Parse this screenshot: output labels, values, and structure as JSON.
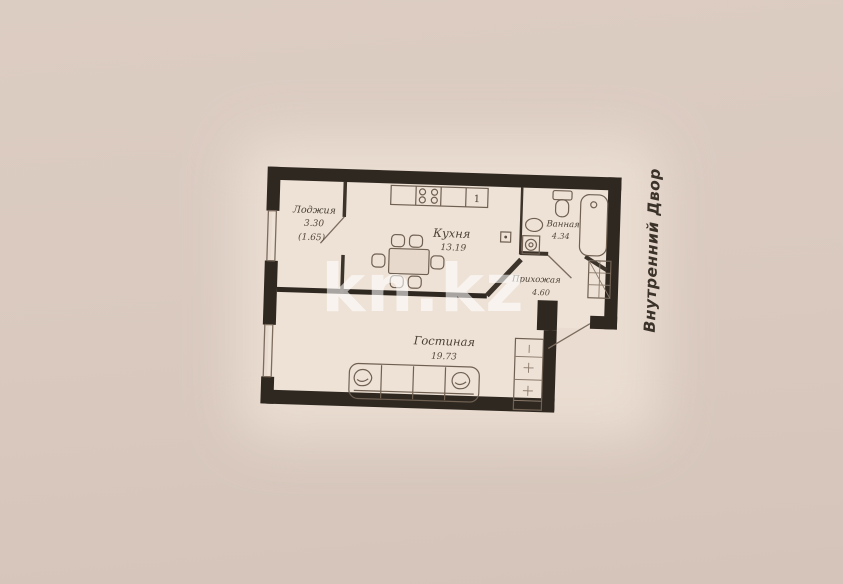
{
  "watermark": {
    "text": "kn.kz"
  },
  "courtyard_label": "Внутренний Двор",
  "rooms": {
    "loggia": {
      "name": "Лоджия",
      "area": "3.30",
      "reduced_area": "(1.65)"
    },
    "kitchen": {
      "name": "Кухня",
      "area": "13.19"
    },
    "bathroom": {
      "name": "Ванная",
      "area": "4.34"
    },
    "hallway": {
      "name": "Прихожая",
      "area": "4.60"
    },
    "living_room": {
      "name": "Гостиная",
      "area": "19.73"
    }
  },
  "markers": {
    "stove_unit": "1"
  },
  "colors": {
    "background": "#d9c9bf",
    "paper": "#ecdfd3",
    "walls": "#2f2821",
    "ink": "#4a4034"
  }
}
